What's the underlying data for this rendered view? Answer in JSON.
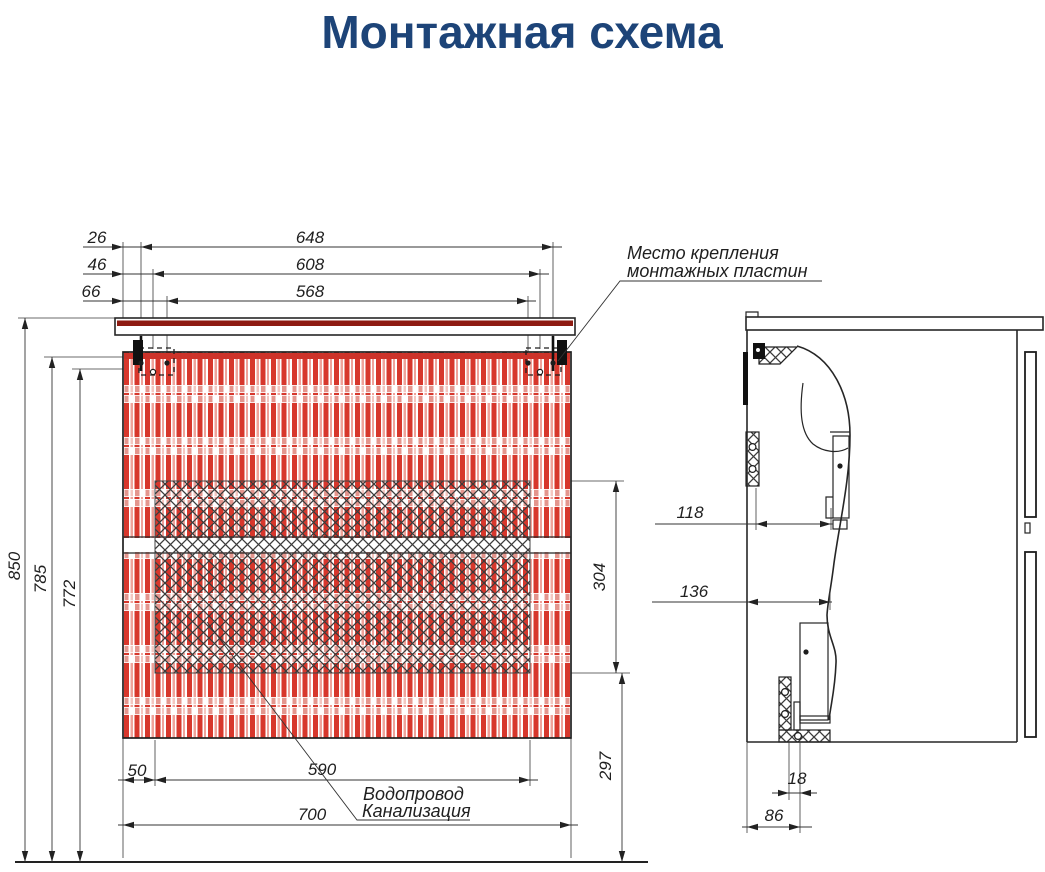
{
  "title": "Монтажная схема",
  "colors": {
    "title": "#1d4478",
    "stripe_red": "#d7372c",
    "stripe_light": "#efa29a",
    "stripe_dash_red": "#e4968e",
    "stripe_dash_light": "#f4c7c1",
    "counter_red": "#8e1b12",
    "panel_top_red": "#cd332a",
    "line": "#262626"
  },
  "front_view": {
    "offset_dims": [
      "26",
      "46",
      "66"
    ],
    "width_dims": [
      "648",
      "608",
      "568"
    ],
    "height_dims": [
      "850",
      "785",
      "772"
    ],
    "recess_dims": [
      "304",
      "297"
    ],
    "bottom_dims": [
      "50",
      "590",
      "700"
    ],
    "mounting_callout": {
      "line1": "Место крепления",
      "line2": "монтажных пластин"
    },
    "utilities_callout": {
      "line1": "Водопровод",
      "line2": "Канализация"
    }
  },
  "side_view": {
    "depth_dims": [
      "118",
      "136"
    ],
    "bottom_dims": [
      "18",
      "86"
    ]
  }
}
